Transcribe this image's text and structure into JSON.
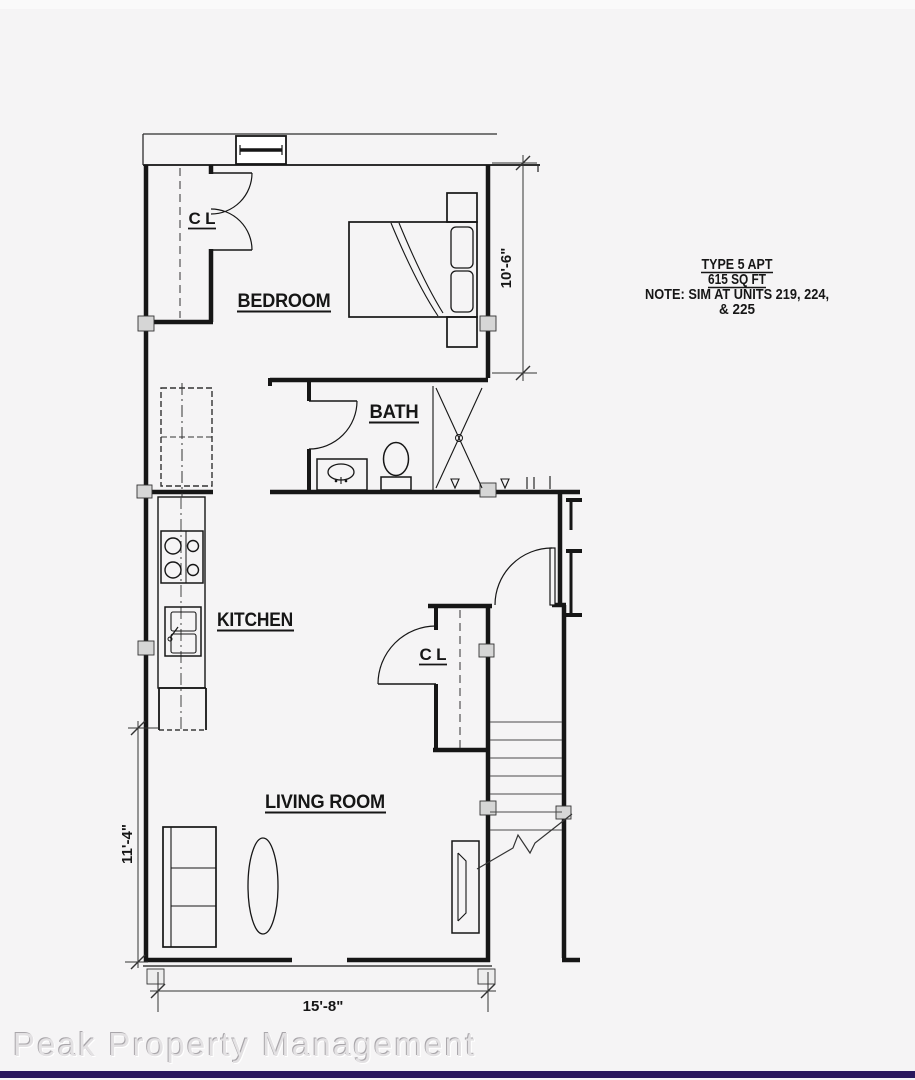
{
  "plan": {
    "title_block": {
      "line1": "TYPE 5 APT",
      "line2": "615 SQ FT",
      "line3": "NOTE: SIM AT UNITS 219, 224,",
      "line4": "& 225"
    },
    "rooms": {
      "bedroom": "BEDROOM",
      "bath": "BATH",
      "kitchen": "KITCHEN",
      "living_room": "LIVING ROOM",
      "bedroom_closet": "CL",
      "entry_closet": "CL"
    },
    "dimensions": {
      "bedroom_depth": "10'-6\"",
      "living_room_depth": "11'-4\"",
      "unit_width": "15'-8\""
    }
  },
  "watermark": "Peak Property Management",
  "colors": {
    "background": "#f5f4f5",
    "line": "#161616",
    "accent_bar": "#2a175c",
    "watermark_text": "#e3e1e3"
  }
}
